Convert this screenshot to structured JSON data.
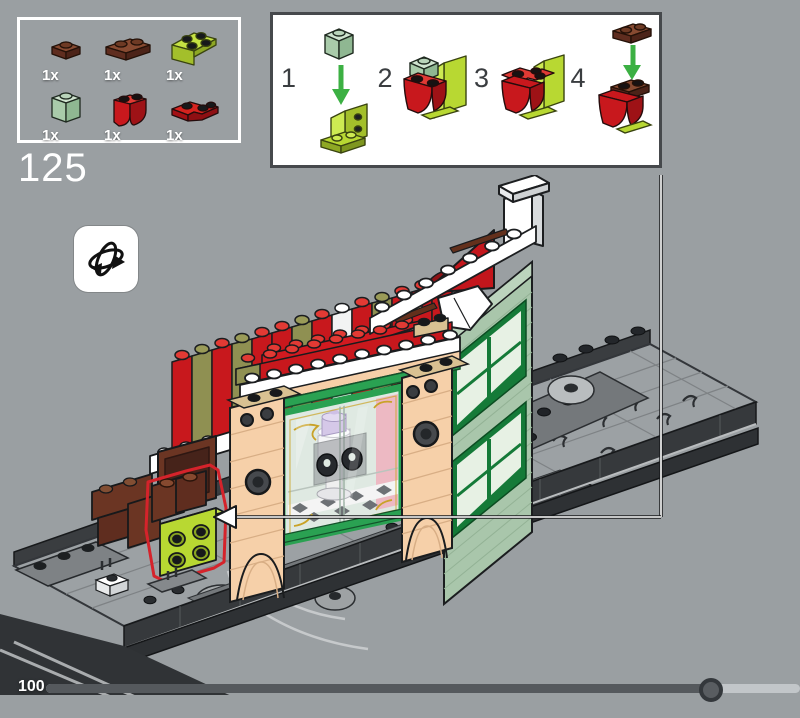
{
  "page": {
    "background": "#9a9fa2"
  },
  "step_label": "125",
  "parts_box": {
    "items": [
      {
        "qty": "1x",
        "part": "brown-plate-1x1"
      },
      {
        "qty": "1x",
        "part": "brown-plate-1x2"
      },
      {
        "qty": "1x",
        "part": "lime-bracket-2x2"
      },
      {
        "qty": "1x",
        "part": "sage-brick-1x1"
      },
      {
        "qty": "1x",
        "part": "red-curved-brick"
      },
      {
        "qty": "1x",
        "part": "red-corner-plate-2x2"
      }
    ]
  },
  "steps_panel": {
    "steps": [
      {
        "num": "1"
      },
      {
        "num": "2"
      },
      {
        "num": "3"
      },
      {
        "num": "4"
      }
    ]
  },
  "progress": {
    "label": "100",
    "percent": 88
  },
  "colors": {
    "background": "#9a9fa2",
    "brick_red": "#c8181d",
    "bright_red": "#e03a34",
    "olive": "#8f9052",
    "lime": "#b8d832",
    "sage": "#aecdb0",
    "sand_green_wall": "#a9c6ab",
    "window_green": "#157a38",
    "storefront_green": "#2aa152",
    "cream": "#f5cfa8",
    "tan": "#d9c192",
    "brown": "#6b3523",
    "white": "#ffffff",
    "base_gray": "#9ca1a4",
    "base_dark": "#36393c",
    "highlight_outline": "#d5232b",
    "arrow_green": "#3cb043"
  }
}
